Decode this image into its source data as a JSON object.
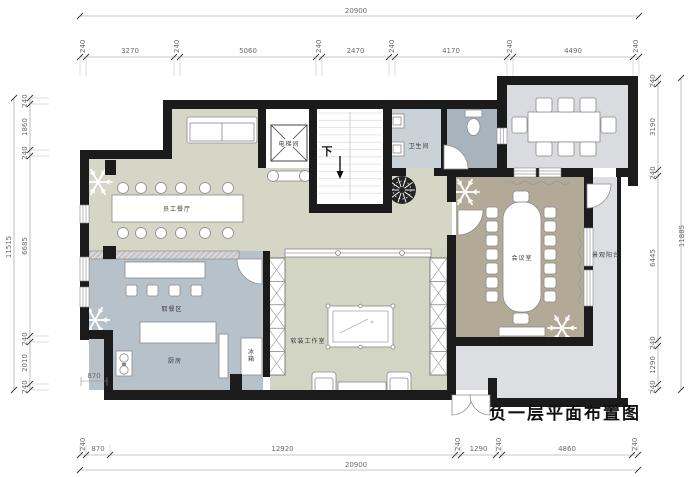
{
  "title": "负一层平面布置图",
  "rooms": {
    "staff_canteen": "员工餐厅",
    "elevator": "电梯间",
    "stair_down": "下",
    "washroom": "卫生间",
    "meeting_room": "会议室",
    "balcony": "景观阳台",
    "meal_pickup": "取餐区",
    "kitchen": "厨房",
    "fridge": "冰箱",
    "studio": "软装工作室"
  },
  "interior_dim": "870",
  "dims": {
    "top": {
      "total": "20900",
      "segments": [
        "240",
        "3270",
        "240",
        "5060",
        "240",
        "2470",
        "240",
        "4170",
        "240",
        "4490",
        "240"
      ]
    },
    "bottom": {
      "total": "20900",
      "segments": [
        "240",
        "870",
        "12920",
        "240",
        "1290",
        "240",
        "4860",
        "240"
      ]
    },
    "left": {
      "total": "11515",
      "segments": [
        "240",
        "1860",
        "240",
        "6685",
        "240",
        "2010",
        "240"
      ]
    },
    "right": {
      "total": "11885",
      "segments": [
        "240",
        "3190",
        "240",
        "6445",
        "240",
        "1290",
        "240"
      ]
    }
  },
  "icons": {
    "snowflake": "snowflake-decor",
    "plant": "potted-plant",
    "stair_arrow": "down-arrow"
  },
  "colors": {
    "wall": "#1b1b1b",
    "canteen": "#d5d6c6",
    "bluegray": "#b7c1c9",
    "washroom": "#c9d2d7",
    "stall": "#a9b3bb",
    "dining": "#d9dbde",
    "meeting": "#b2a996",
    "balcony": "#dcdee1",
    "studio": "#d2d4c4",
    "dimline": "#8f8f8f"
  }
}
